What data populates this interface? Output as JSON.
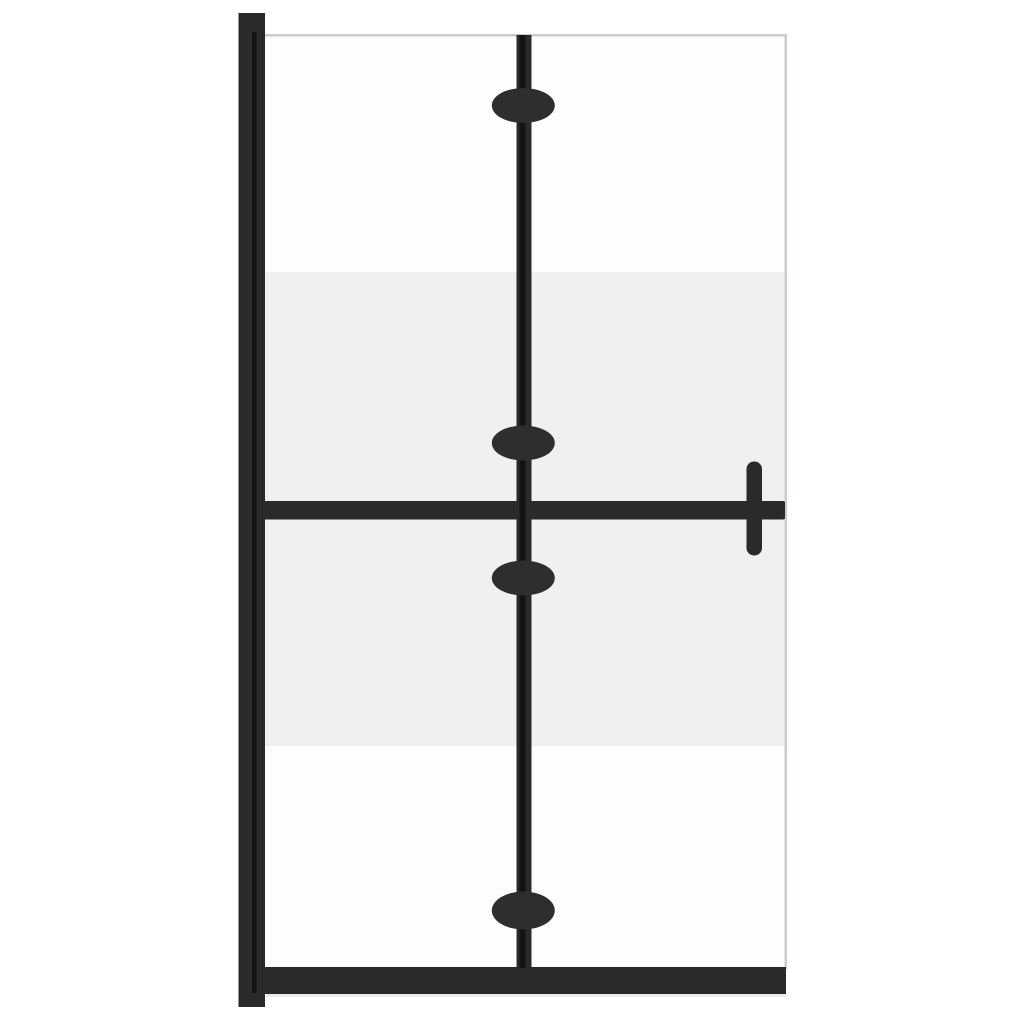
{
  "image": {
    "type": "product-photo",
    "subject": "foldable walk-in shower glass wall, two hinged panels, black frame, half-frosted glass band, side stabilizer bar with handle"
  },
  "colors": {
    "background": "#ffffff",
    "frame_black": "#2a2a2b",
    "seam_black": "#131313",
    "hinge_knob": "#2e2e30",
    "frosted_glass": "#f0f0f1",
    "clear_glass": "#fdfdfd",
    "glass_edge": "#c9cccd",
    "floor_shadow": "#d9d9d9"
  },
  "parts": {
    "wall_profile": "wall mounting profile",
    "glass_panel": "glass panel",
    "frosted_band": "frosted glass band",
    "center_hinge": "center folding hinge bar",
    "hinge_knobs": "hinge knobs",
    "stabilizer_bar": "horizontal stabilizer bar",
    "handle": "handle bar",
    "bottom_rail": "bottom frame rail"
  }
}
